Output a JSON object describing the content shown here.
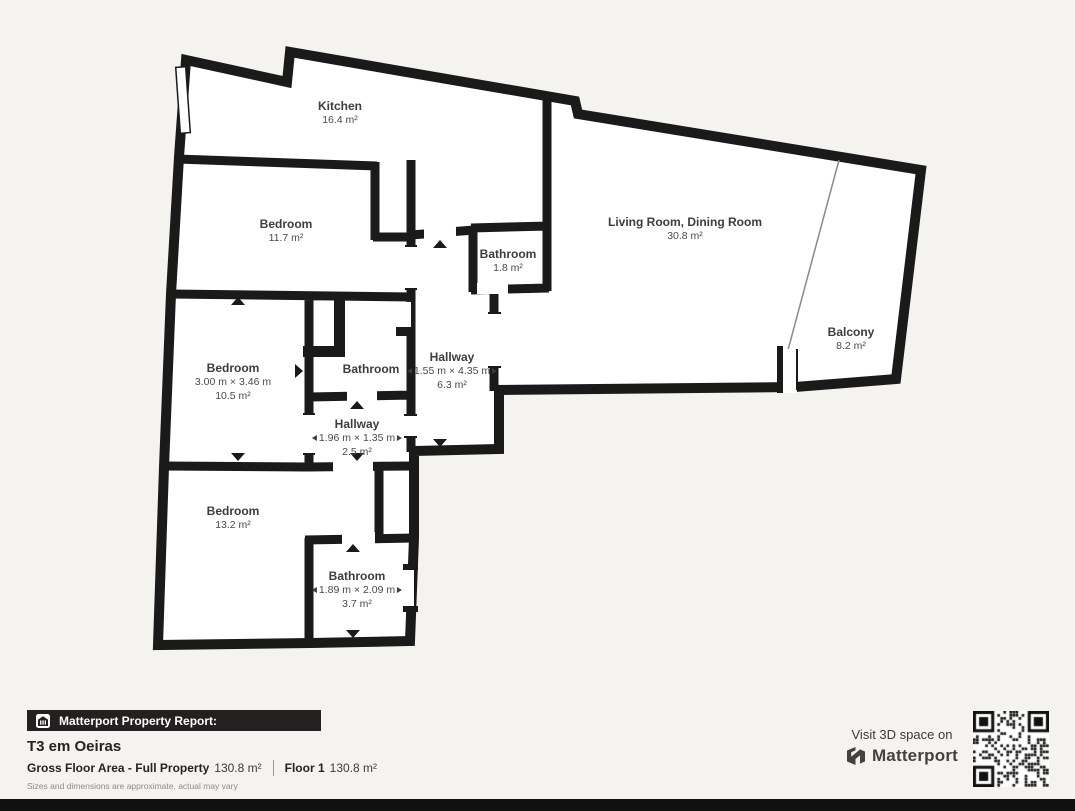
{
  "floorplan": {
    "rooms": {
      "kitchen": {
        "name": "Kitchen",
        "area": "16.4 m²"
      },
      "bedroom_top": {
        "name": "Bedroom",
        "area": "11.7 m²"
      },
      "living_room": {
        "name": "Living Room, Dining Room",
        "area": "30.8 m²"
      },
      "bathroom_top": {
        "name": "Bathroom",
        "area": "1.8 m²"
      },
      "bedroom_mid": {
        "name": "Bedroom",
        "dims": "3.00 m × 3.46 m",
        "area": "10.5 m²"
      },
      "bathroom_mid": {
        "name": "Bathroom"
      },
      "hallway_main": {
        "name": "Hallway",
        "dims": "1.55 m × 4.35 m",
        "area": "6.3 m²"
      },
      "hallway_small": {
        "name": "Hallway",
        "dims": "1.96 m × 1.35 m",
        "area": "2.5 m²"
      },
      "bedroom_bottom": {
        "name": "Bedroom",
        "area": "13.2 m²"
      },
      "bathroom_bottom": {
        "name": "Bathroom",
        "dims": "1.89 m × 2.09 m",
        "area": "3.7 m²"
      },
      "balcony": {
        "name": "Balcony",
        "area": "8.2 m²"
      }
    }
  },
  "footer": {
    "report_label": "Matterport Property Report:",
    "property_title": "T3 em Oeiras",
    "gross_floor_label": "Gross Floor Area - Full Property",
    "gross_floor_value": "130.8 m²",
    "floor_label": "Floor 1",
    "floor_value": "130.8 m²",
    "disclaimer": "Sizes and dimensions are approximate, actual may vary"
  },
  "cta": {
    "visit_text": "Visit 3D space on",
    "brand": "Matterport"
  },
  "icons": {
    "banner_icon": "house-report-icon",
    "brand_icon": "matterport-logo-icon",
    "qr": "qr-code"
  },
  "colors": {
    "background": "#f4f3f0",
    "wall": "#1a1a1a",
    "room_fill": "#ffffff",
    "room_text": "#3d3d3d",
    "banner": "#242021",
    "bottom_bar": "#101010"
  }
}
